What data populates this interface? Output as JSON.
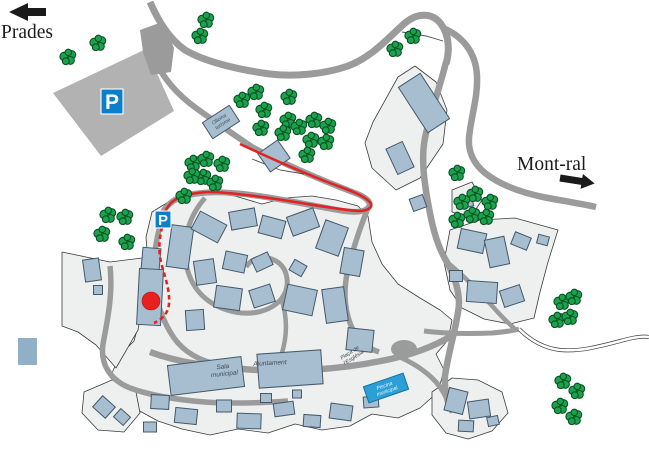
{
  "map": {
    "destination_west": "Prades",
    "destination_east": "Mont-ral",
    "parking_symbol": "P",
    "places": {
      "tourist_office": [
        "Oficina",
        "turisme"
      ],
      "sala_municipal": [
        "Sala",
        "municipal"
      ],
      "ajuntament": "Ajuntament",
      "placa_esglesia": [
        "Plaça de",
        "l'Església"
      ],
      "piscina_municipal": [
        "Piscina",
        "municipal"
      ]
    },
    "colors": {
      "building": "#a6bed0",
      "village_block": "#edf0ee",
      "road": "#9b9b9b",
      "parking_area": "#b2b2b2",
      "tree": "#1aa34a",
      "route": "#e32222",
      "parking_sign": "#0a80cc",
      "pool": "#2b9fd6",
      "legend_swatch": "#8fb0c6"
    }
  }
}
